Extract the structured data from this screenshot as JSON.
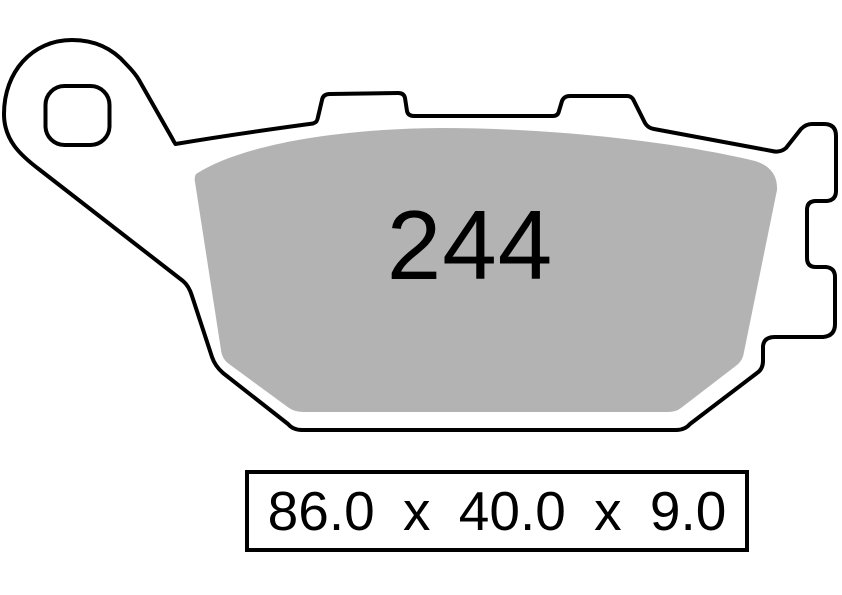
{
  "diagram": {
    "title": "brake-pad-profile",
    "part_number": "244",
    "dimensions_label": "86.0 x 40.0 x 9.0",
    "dimensions": {
      "length_mm": "86.0",
      "width_mm": "40.0",
      "thickness_mm": "9.0",
      "separator": "x"
    },
    "colors": {
      "pad_fill": "#b3b3b3",
      "outline": "#000000",
      "plate_fill": "#ffffff",
      "background": "#ffffff"
    }
  }
}
